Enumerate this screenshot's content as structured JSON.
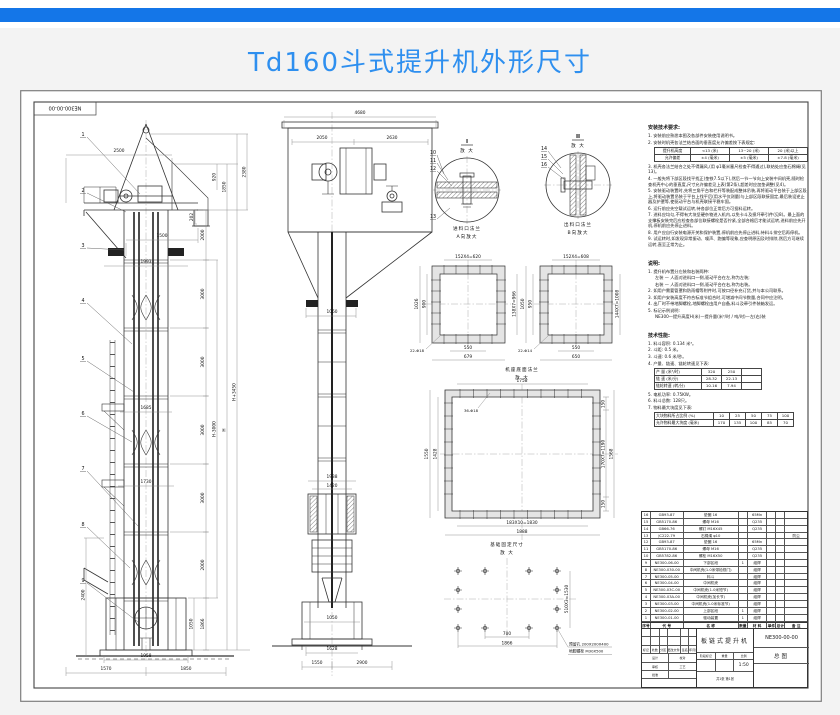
{
  "header": {
    "title": "Td160斗式提升机外形尺寸"
  },
  "sheet": {
    "corner_code": "NE300-00-00"
  },
  "left_view": {
    "balloons": [
      "1",
      "2",
      "3",
      "4",
      "5",
      "6",
      "7",
      "8",
      "9"
    ],
    "dim_top_width": "2500",
    "dim_head_total": "2380",
    "dim_hood_top": "920",
    "dim_hood": "1850",
    "dim_spout": "202",
    "dim_spout_offset": "1500",
    "dim_platform": "1993",
    "chain": [
      "2000",
      "3000",
      "3000",
      "3000",
      "3000",
      "2000",
      "1866"
    ],
    "dim_h_minus": "H-3000",
    "dim_h": "H",
    "dim_h_plus": "H+3450",
    "dim_walkway_upper": "1685",
    "dim_walkway_lower": "1730",
    "dim_pit_depth": "2400",
    "dim_boot_h": "1050",
    "dim_base_w": "1958",
    "dim_base_left": "1570",
    "dim_base_right": "1850"
  },
  "front_view": {
    "dim_top_width": "4680",
    "dim_left": "2050",
    "dim_right": "2630",
    "dim_column": "1060",
    "dim_takeup_outer": "1938",
    "dim_takeup_inner": "1420",
    "dim_boot_w": "1050",
    "dim_base_w": "1628",
    "dim_found_left": "1550",
    "dim_found_right": "2900"
  },
  "details": {
    "i": {
      "mark": "I",
      "zoom": "放 大",
      "balloons": [
        "10",
        "11",
        "12",
        "13"
      ]
    },
    "ii": {
      "mark": "II",
      "zoom": "放 大",
      "balloons": [
        "14",
        "15",
        "16"
      ]
    },
    "inlet_title": "进料口法兰",
    "inlet_sub": "A向放大",
    "outlet_title": "出料口法兰",
    "outlet_sub": "B向放大"
  },
  "flange_a": {
    "top": "152X4=620",
    "left_outer": "1026",
    "left_inner": "900",
    "right": "138X7=966",
    "bottom_inner": "550",
    "bottom_outer": "679",
    "holes": "22-Φ18"
  },
  "flange_b": {
    "top": "152X4=608",
    "left_outer": "1050",
    "left_inner": "950",
    "right": "144X7=1008",
    "bottom_inner": "550",
    "bottom_outer": "650",
    "holes": "22-Φ14"
  },
  "base_flange": {
    "title": "机座底面法兰",
    "sub": "放 大",
    "top": "1758",
    "left_outer": "1550",
    "left_inner": "1428",
    "right_top": "150",
    "right_mid": "170X7=1190",
    "right_bottom": "150",
    "right_outer": "1568",
    "bottom_inner": "183X10=1830",
    "bottom_outer": "1888",
    "holes": "36-Φ18"
  },
  "foundation": {
    "title": "基础固定尺寸",
    "sub": "放 大",
    "dim_inner": "700",
    "dim_outer": "1866",
    "dim_vertical": "510X3=1530",
    "note_hole": "预留孔 200X200X400",
    "note_bolt": "地脚螺栓 M30X500"
  },
  "install": {
    "title": "安装技术要求:",
    "items": [
      "1. 安装前应熟悉本图及各部件安装使用说明书。",
      "2. 安装时机壳各法兰结合面的垂直度允许偏差按下表规定:",
      "3. 机壳各法兰结合之处不得漏风,(用 φ1毫米塞尺检查不得通过),联结处应垫石棉绳(见13)。",
      "4. 一般先将下部区段找平找正(垫铁7.5以下),然后一节一节向上安装中间机壳,随时检查机壳中心的垂直度,尺寸允许偏差见上表(第2条),超差时应加垫调整(见4)。",
      "5. 安装驱动装置时,先将三角平台和栏杆等装配成整体吊装,再将驱动平台装于上部区段上,将驱动装置吊装于平台上找平后(用水平仪测量)与上部区段联接固定,最后装设逆止器及护罩等,使驱动平台与机壳联接平稳牢固。",
      "6. 运行前应先空载试运转,待各部位正常后方可投料运转。",
      "7. 进料应均匀,不得有大块坚硬杂物进入机内,以免卡斗及损坏牵引件(见8)。最上面的支撑板安装完后应检查各部位联接螺栓是否拧紧,全部合格后才能试运转,进料前应先开机,停机前应先停止进料。",
      "8. 用户应自行安装电源开关和保护装置,停机前应先停止进料,待料斗排空后再停机。",
      "9. 试运转时,如发现异常振动、噪声、跑偏等现象,应查明原因及时排除,然后方可继续运转,直至正常为止。"
    ],
    "table": [
      [
        "提升机高度",
        "<13 (米)",
        "13~20 (米)",
        "20 (米)以上"
      ],
      [
        "允许偏差",
        "±4 (毫米)",
        "±5 (毫米)",
        "±7.8 (毫米)"
      ]
    ]
  },
  "remarks": {
    "title": "说明:",
    "items": [
      "1. 提升机布置分左装和右装两种:",
      "左装 — 人面对进料口一侧,驱动平台在左,称为左装;",
      "右装 — 人面对进料口一侧,驱动平台在右,称为右装。",
      "2. 如用户需要管罩和防雨帽等附件时,可按口径补充订货,并与本公司联系。",
      "3. 如用户安装高度不符合标准节组合时,可增减中间节数量,合同中应注明。",
      "4. 出厂时不带地脚螺栓,地脚螺栓由用户自备,料斗及牵引件装箱发运。",
      "5. 标记示例说明:"
    ],
    "formula": "NE300—提升高度H(米)—提升量(米³/时 / 吨/时)—左(右)装"
  },
  "tech": {
    "title": "技术性能:",
    "items": [
      "1. 料斗容积: 0.134 米³。",
      "2. 斗距: 0.5 米。",
      "3. 斗速: 0.6 米/秒。",
      "4. 产量、链速、链轮转速见下表:",
      "5. 电机功率: 0.75KW。",
      "6. 料斗总数: 128只。",
      "7. 物料最大块度见下表:"
    ],
    "perf_table": [
      [
        "产 量 (米³/时)",
        "320",
        "250",
        ""
      ],
      [
        "链 速 (米/分)",
        "28.32",
        "22.13",
        ""
      ],
      [
        "链轮转速 (转/分)",
        "10.16",
        "7.94",
        ""
      ]
    ],
    "block_table": [
      [
        "大块物料所占比例 (%)",
        "10",
        "25",
        "50",
        "75",
        "100"
      ],
      [
        "允许物料最大块度 (毫米)",
        "170",
        "135",
        "100",
        "85",
        "70"
      ]
    ]
  },
  "bom": {
    "header": [
      "序号",
      "代  号",
      "名  称",
      "数量",
      "材 料",
      "单件",
      "总计",
      "备 注"
    ],
    "rows": [
      [
        "16",
        "GB93-87",
        "垫圈 16",
        "",
        "65Mn",
        ""
      ],
      [
        "15",
        "GB5170-86",
        "螺母 M16",
        "",
        "Q235",
        ""
      ],
      [
        "14",
        "GB66-76",
        "螺钉 M16X45",
        "",
        "Q235",
        ""
      ],
      [
        "13",
        "JC222-79",
        "石棉绳 φ10",
        "",
        "",
        "防尘"
      ],
      [
        "12",
        "GB93-87",
        "垫圈 16",
        "",
        "65Mn",
        ""
      ],
      [
        "11",
        "GB5170-86",
        "螺母 M16",
        "",
        "Q235",
        ""
      ],
      [
        "10",
        "GB5782-86",
        "螺栓 M16X50",
        "",
        "Q235",
        ""
      ],
      [
        "9",
        "NE300-06-00",
        "下部区段",
        "1",
        "组焊",
        ""
      ],
      [
        "8",
        "NE300-030-00",
        "中间机壳(1.0米带检视门)",
        "",
        "组焊",
        ""
      ],
      [
        "7",
        "NE300-05-00",
        "料斗",
        "",
        "组焊",
        ""
      ],
      [
        "6",
        "NE300-04-00",
        "中间机壳",
        "",
        "组焊",
        ""
      ],
      [
        "5",
        "NE300-03C-00",
        "中间机壳(1.0米短节)",
        "",
        "组焊",
        ""
      ],
      [
        "4",
        "NE300-03A-00",
        "中间机壳(加长节)",
        "",
        "组焊",
        ""
      ],
      [
        "3",
        "NE300-03-00",
        "中间机壳(1.0米标准节)",
        "",
        "组焊",
        ""
      ],
      [
        "2",
        "NE300-02-00",
        "上部区段",
        "1",
        "组焊",
        ""
      ],
      [
        "1",
        "NE300-01-00",
        "驱动装置",
        "1",
        "组焊",
        ""
      ]
    ]
  },
  "title_block": {
    "name": "板链式提升机",
    "code": "NE300-00-00",
    "doc_type": "总图",
    "scale": "1:50",
    "rev_labels": [
      "标记",
      "处数",
      "分区",
      "更改文件号",
      "签名",
      "年月日"
    ],
    "sign_labels": [
      "设计",
      "校对",
      "审核",
      "工艺",
      "批准"
    ],
    "misc_labels": [
      "阶段标记",
      "重量",
      "比例"
    ],
    "sheet_note": "共1张 第1张"
  }
}
